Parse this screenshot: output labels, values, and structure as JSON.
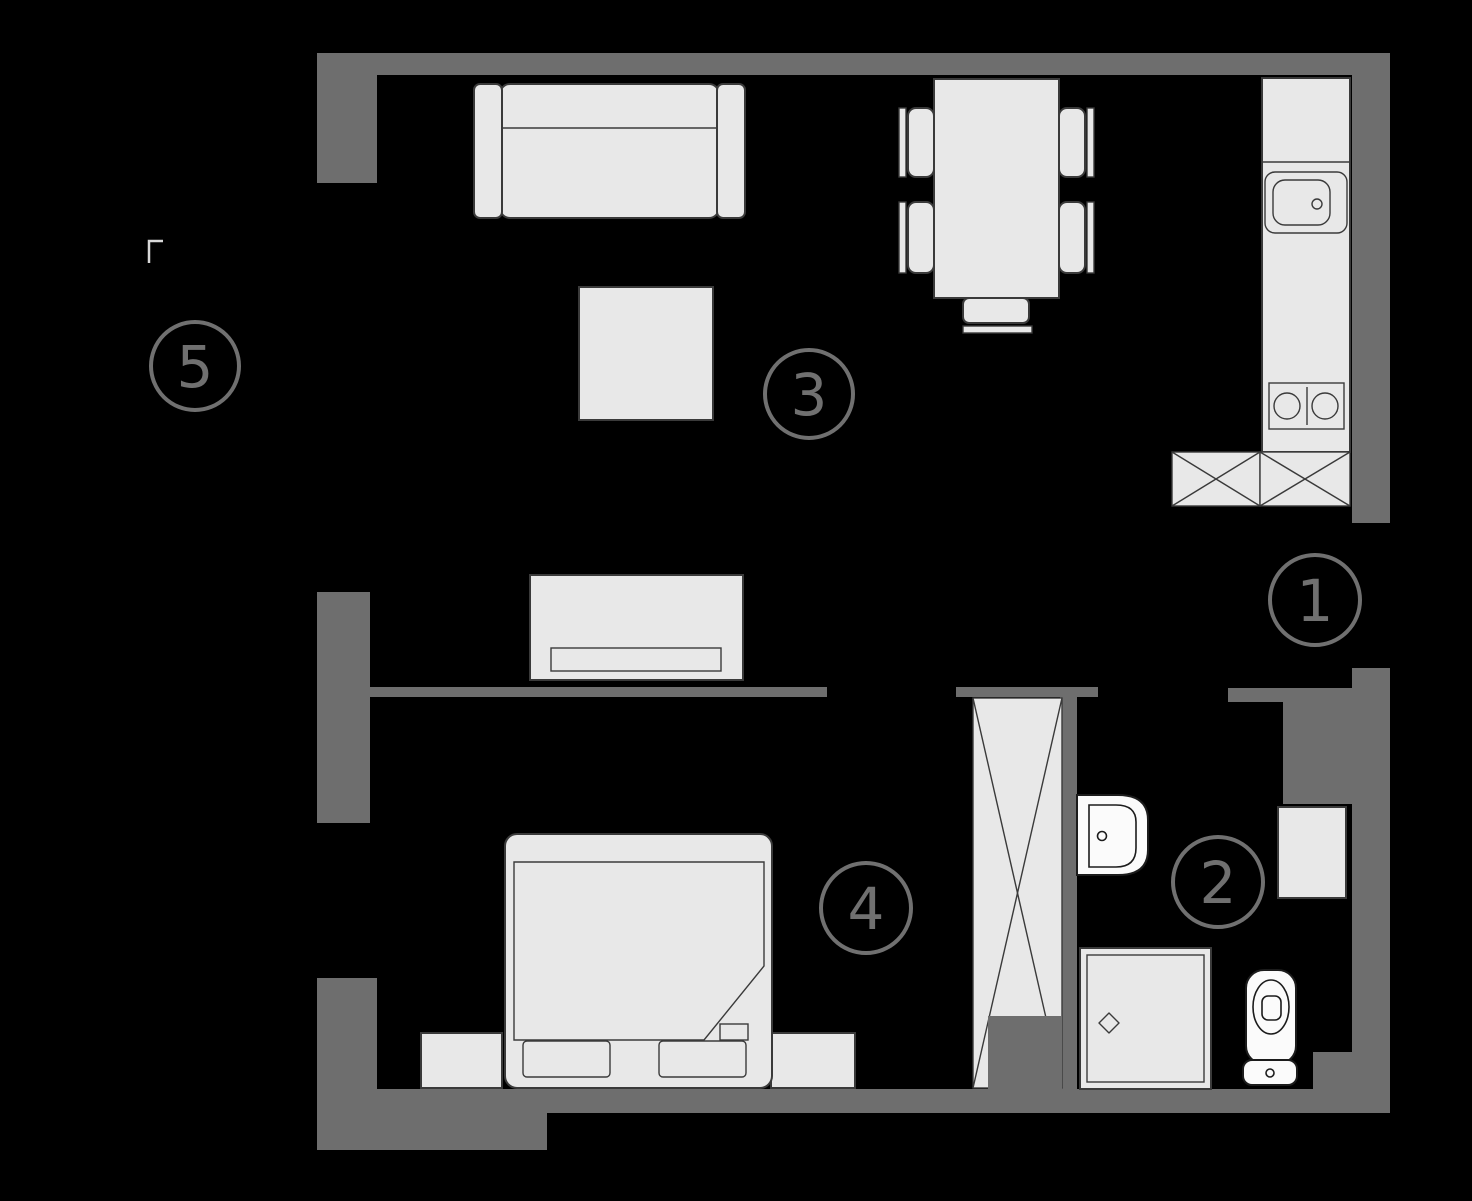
{
  "title": "apartment-floor-plan",
  "colors": {
    "background": "#000000",
    "wall": "#6e6e6e",
    "furniture_fill": "#e8e8e8",
    "furniture_stroke": "#3a3a3a",
    "fixture_fill": "#fbfbfb",
    "fixture_stroke": "#1c1c1c",
    "label": "#707070"
  },
  "rooms": [
    {
      "number": "1"
    },
    {
      "number": "2"
    },
    {
      "number": "3"
    },
    {
      "number": "4"
    },
    {
      "number": "5"
    }
  ],
  "furniture_icons": [
    "sofa-icon",
    "coffee-table-icon",
    "tv-stand-icon",
    "dining-table-icon",
    "dining-chair-icon",
    "kitchen-counter-icon",
    "kitchen-sink-icon",
    "stove-icon",
    "cabinet-x-icon",
    "bed-icon",
    "nightstand-icon",
    "pillow-icon",
    "wardrobe-icon",
    "bathroom-sink-icon",
    "shower-icon",
    "toilet-icon",
    "washing-machine-icon"
  ]
}
